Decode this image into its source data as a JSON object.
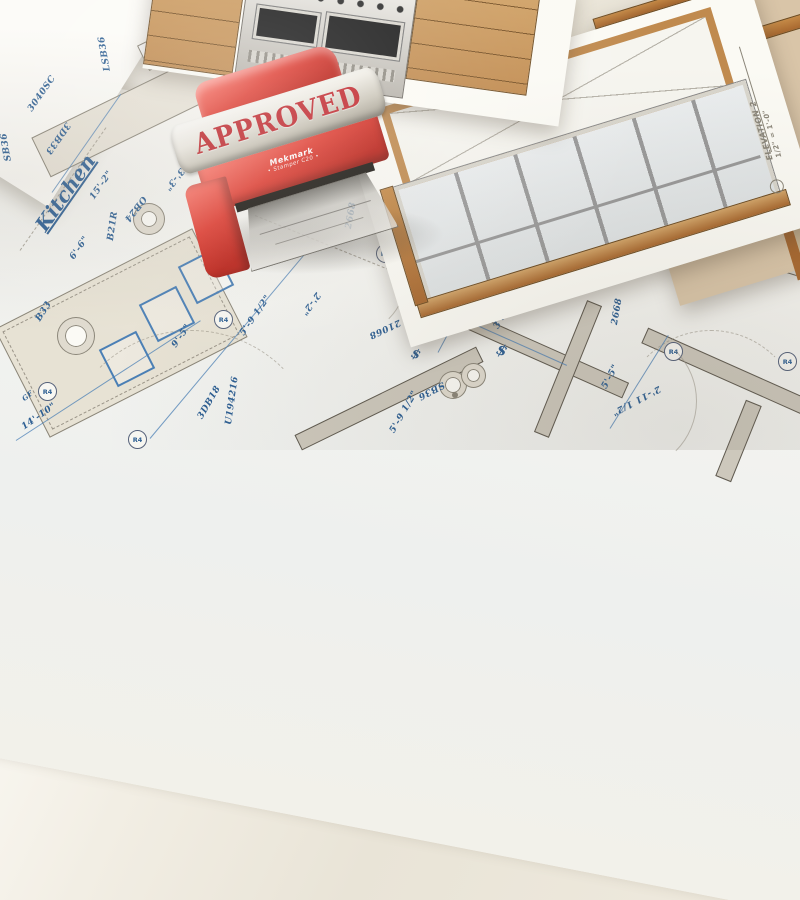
{
  "stamp": {
    "text": "APPROVED",
    "brand": "Mekmark",
    "model": "• Stamper C20 •"
  },
  "rooms": {
    "kitchen": "Kitchen",
    "butlers_line1": "Butlers",
    "butlers_line2": "Pantry",
    "pantry": "Pantry"
  },
  "symbols": {
    "recessed_light": "R4",
    "switch": "$",
    "gfci": "GF"
  },
  "elevation": {
    "title": "ELEVATION 2",
    "scale": "1/2\" = 1'-0\""
  },
  "pencil_notes": {
    "existing_window_1": "EXISTING",
    "existing_window_2": "WINDOW"
  },
  "plan_labels": [
    {
      "text": "3040SC"
    },
    {
      "text": "3DB33"
    },
    {
      "text": "LSB36"
    },
    {
      "text": "SB36"
    },
    {
      "text": "15'-2\""
    },
    {
      "text": "6'-6\""
    },
    {
      "text": "B21R"
    },
    {
      "text": "OB24"
    },
    {
      "text": "3'-3\""
    },
    {
      "text": "B33"
    },
    {
      "text": "14'-10\""
    },
    {
      "text": "3DB18"
    },
    {
      "text": "U194216"
    },
    {
      "text": "9'-5\""
    },
    {
      "text": "5'-9 1/2\""
    },
    {
      "text": "5'-9 1/2\""
    },
    {
      "text": "2'-2\""
    },
    {
      "text": "2668"
    },
    {
      "text": "3DB18"
    },
    {
      "text": "SB24"
    },
    {
      "text": "B26"
    },
    {
      "text": "W1842"
    },
    {
      "text": "3DB16"
    },
    {
      "text": "21068"
    },
    {
      "text": "4'-3\""
    },
    {
      "text": "3'5.5\""
    },
    {
      "text": "5'-5\""
    },
    {
      "text": "5'-5\""
    },
    {
      "text": "2668"
    },
    {
      "text": "2'-11 1/2\""
    },
    {
      "text": "3440DH"
    },
    {
      "text": "SB36"
    }
  ],
  "colors": {
    "blueprint_blue": "#2d5f93",
    "stamp_red": "#e03c31",
    "silver_band": "#d8d4c9",
    "cabinet_tan": "#c08a4e",
    "wall_gray": "#cdc8bc",
    "paper": "#f6f5f0"
  }
}
